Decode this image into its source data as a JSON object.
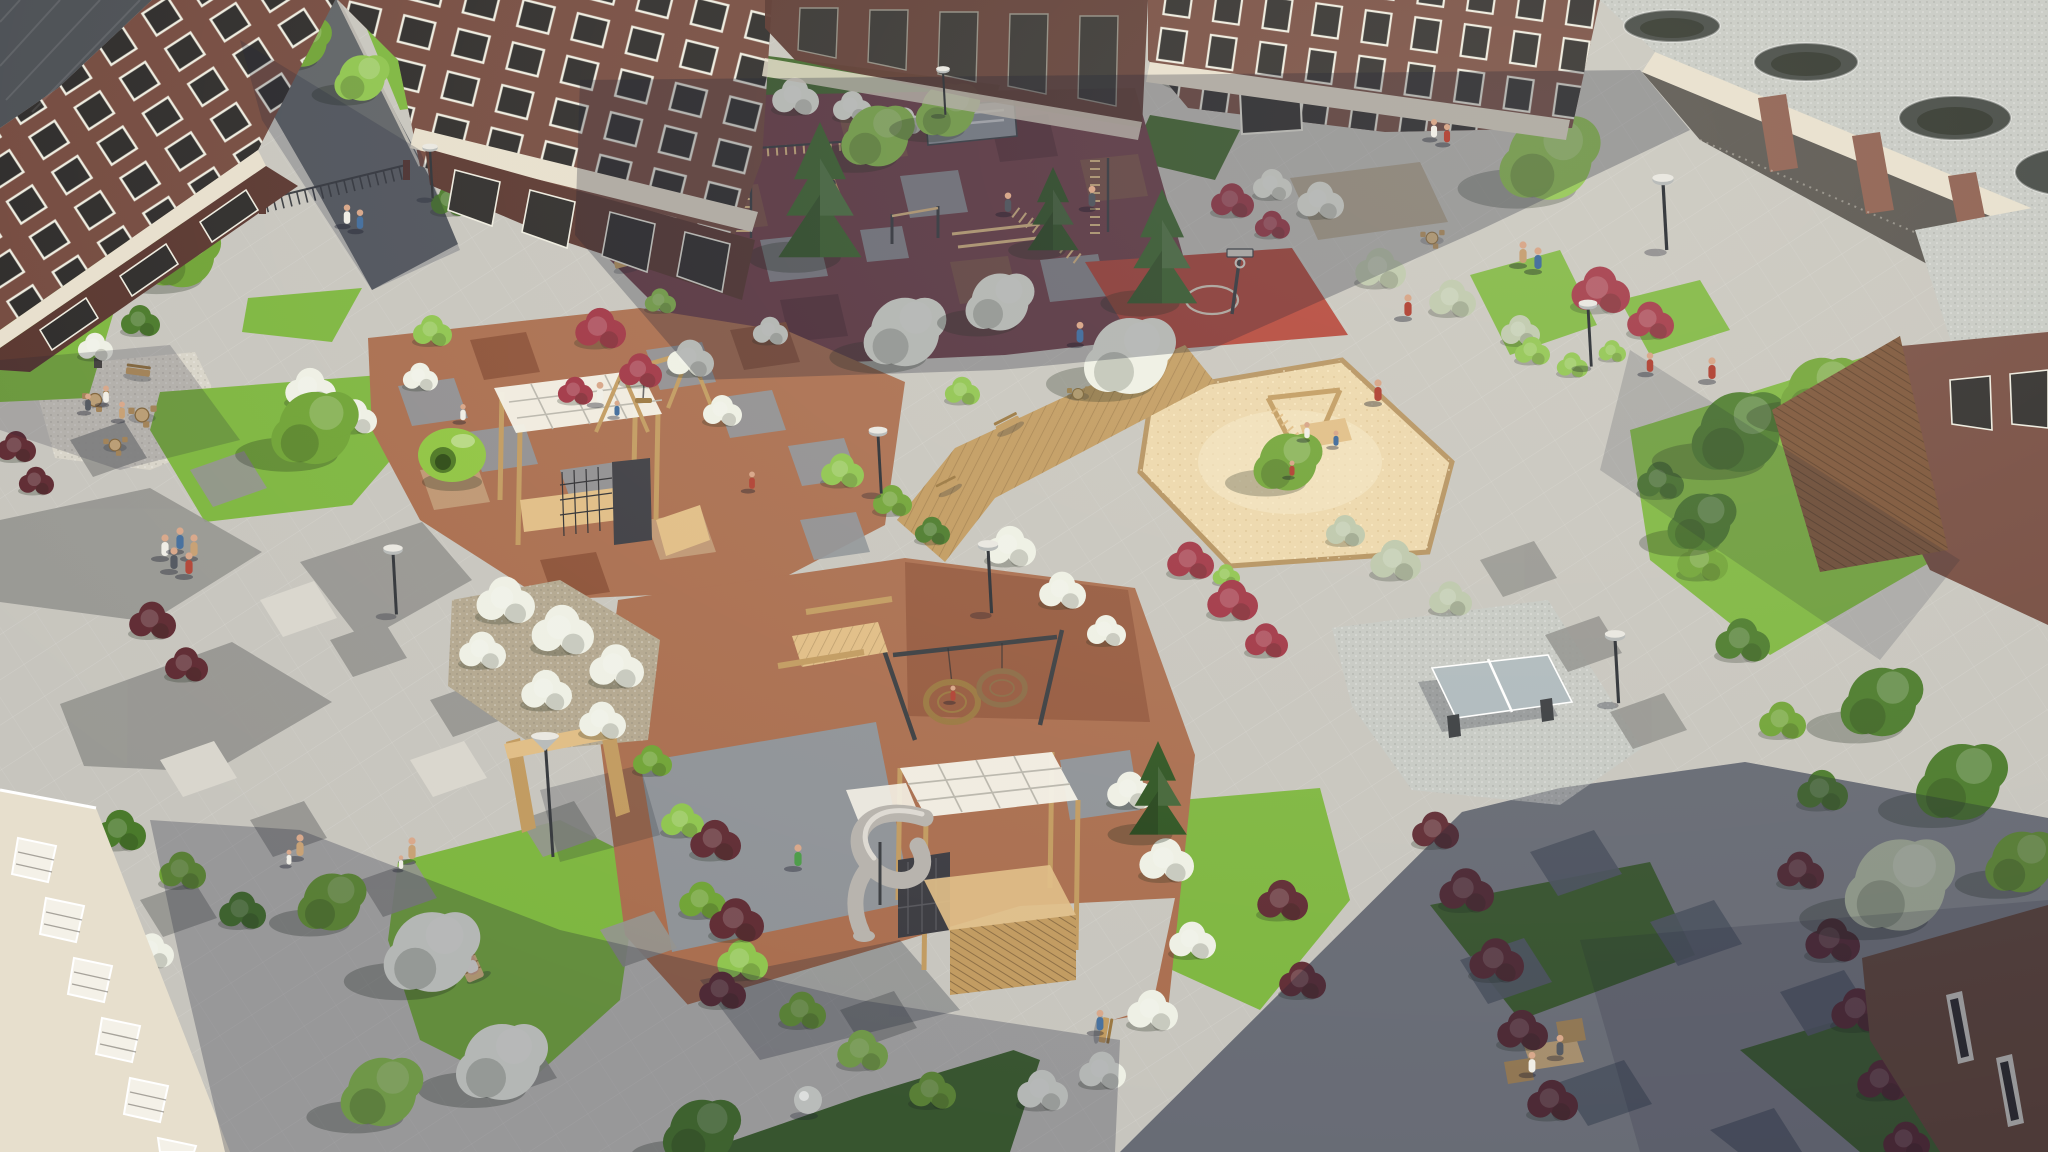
{
  "scene": {
    "type": "photorealistic-aerial-render",
    "subject": "Bird's-eye view of a landscaped residential courtyard with playgrounds between brick apartment buildings",
    "lighting": "sunny day, long soft shadows falling toward the lower left",
    "visible_text": "none"
  },
  "palette": {
    "pave": "#c7c5be",
    "paveDark": "#adaca6",
    "paveDarker": "#93938f",
    "paveLight": "#dbd8cf",
    "chev": "#5c646f",
    "road": "#5e6266",
    "gravel": "#d8d4c9",
    "gravelCool": "#c6c9c4",
    "sand": "#ecd7ab",
    "sandLight": "#f6e8c6",
    "stone": "#b3a78f",
    "rubRed": "#6e3d47",
    "rubRedDark": "#59303a",
    "rubBrown": "#7c5347",
    "rubGray": "#8e9297",
    "rubTan": "#c09a76",
    "terra": "#a96d4e",
    "terraDark": "#8a4f36",
    "court": "#b34438",
    "grass": "#7db63f",
    "grassDark": "#55842c",
    "grassShade": "#41682c",
    "leaf1": "#6fa335",
    "leaf2": "#8ec44e",
    "leaf3": "#4a7a2b",
    "sage": "#bcc7ab",
    "bloom": "#eef0e5",
    "red1": "#a03444",
    "red2": "#5f2b33",
    "pine": "#3e6b2e",
    "pineDark": "#2e5422",
    "trunk": "#7b5b3e",
    "wood": "#c19a5f",
    "woodDark": "#99763f",
    "woodLight": "#e0bd85",
    "brick": "#744a3f",
    "brickDark": "#59362f",
    "brickLight": "#8a5a4b",
    "cream": "#e7dfcd",
    "glass": "#2d2b2a",
    "frame": "#edebdf",
    "slate": "#4b4f54",
    "metal": "#393c40",
    "slide": "#b6b2ac",
    "slideLight": "#ddd9d2",
    "canopy": "#f3f0e6",
    "ppTable": "#aeb9bd",
    "skin": "#d9a98c",
    "shirtWhite": "#f0eee6",
    "shirtRed": "#b44a3c",
    "shirtBlue": "#49729f",
    "shirtGreen": "#4f9d4b",
    "shirtTan": "#c8a276",
    "pants": "#565b63",
    "lampGray": "#b9bcba"
  },
  "objects": {
    "buildings": [
      "brick apartment block top-left with slate roof",
      "brick apartment block top-center-left with cream fascia and storefront glazing",
      "shaded brick facade top-center",
      "brick apartment wing top-right",
      "pergola walkway with gravel roof and round openings, top-right corner",
      "brick building with wooden slat screen, right edge",
      "white residential building with balconies, bottom-left",
      "brown building corner, bottom-right"
    ],
    "recreation": [
      "calisthenics workout zone on dark-red rubber patchwork",
      "streetball half-court with hoop",
      "toddler playground: climbing frame with white canopy, A-frame swing, green egg play pod",
      "large sandbox with timber climbing frame",
      "double nest (basket) swing",
      "play tower with white grid canopies and silver spiral tube slide",
      "table-tennis table on gravel pad"
    ],
    "site_furniture": [
      "asphalt access road with metal fence and entrance gate",
      "timber boardwalk with benches and cafe table",
      "picnic table",
      "park benches",
      "cafe table-and-chair sets",
      "gabion planters with white flowering shrubs",
      "wooden pergola portal",
      "two wooden sun loungers on lawn",
      "street lamps and sphere bollard light"
    ],
    "vegetation": [
      "diamond-pattern paved plaza lawns",
      "white flowering shrubs",
      "sage-green shrubs",
      "red barberry shrubs and hedges",
      "ball topiary",
      "pine trees",
      "deciduous trees"
    ],
    "people_count": 37,
    "lamps_count": 10
  }
}
